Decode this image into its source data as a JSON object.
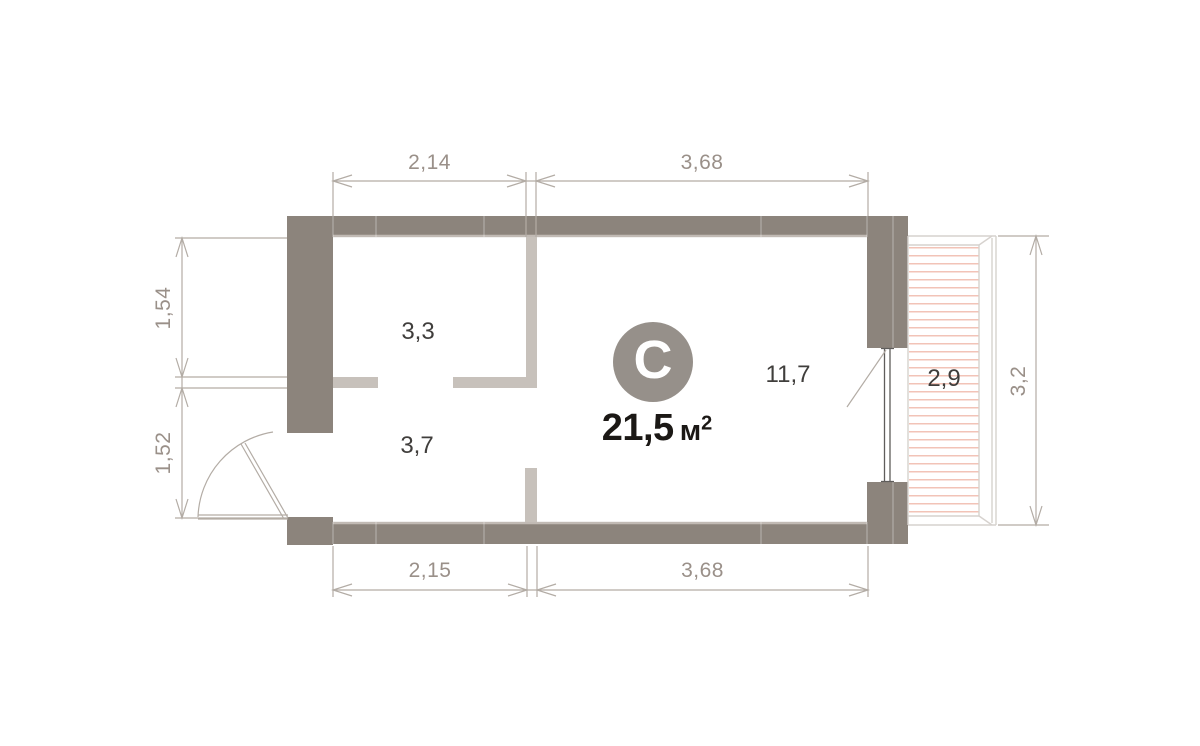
{
  "unit": {
    "type_letter": "С",
    "area_value": "21,5",
    "area_unit": "м",
    "area_exponent": "2"
  },
  "rooms": {
    "room_top": "3,3",
    "room_bottom": "3,7",
    "living_room": "11,7",
    "balcony": "2,9"
  },
  "dimensions": {
    "top_left": "2,14",
    "top_right": "3,68",
    "bottom_left": "2,15",
    "bottom_right": "3,68",
    "left_upper": "1,54",
    "left_lower": "1,52",
    "right": "3,2"
  },
  "colors": {
    "bg": "#ffffff",
    "wall": "#8C847C",
    "wall_edge": "#C6C0BA",
    "partition": "#C7C1BB",
    "dim": "#B3ACA5",
    "dim_text": "#9A9089",
    "room_text": "#403E3C",
    "area_text": "#1B1815",
    "circle_bg": "#96908A",
    "balcony_line": "#D6D2CE",
    "hatch": "#F2C3B7",
    "glass": "#5F5D5B"
  }
}
